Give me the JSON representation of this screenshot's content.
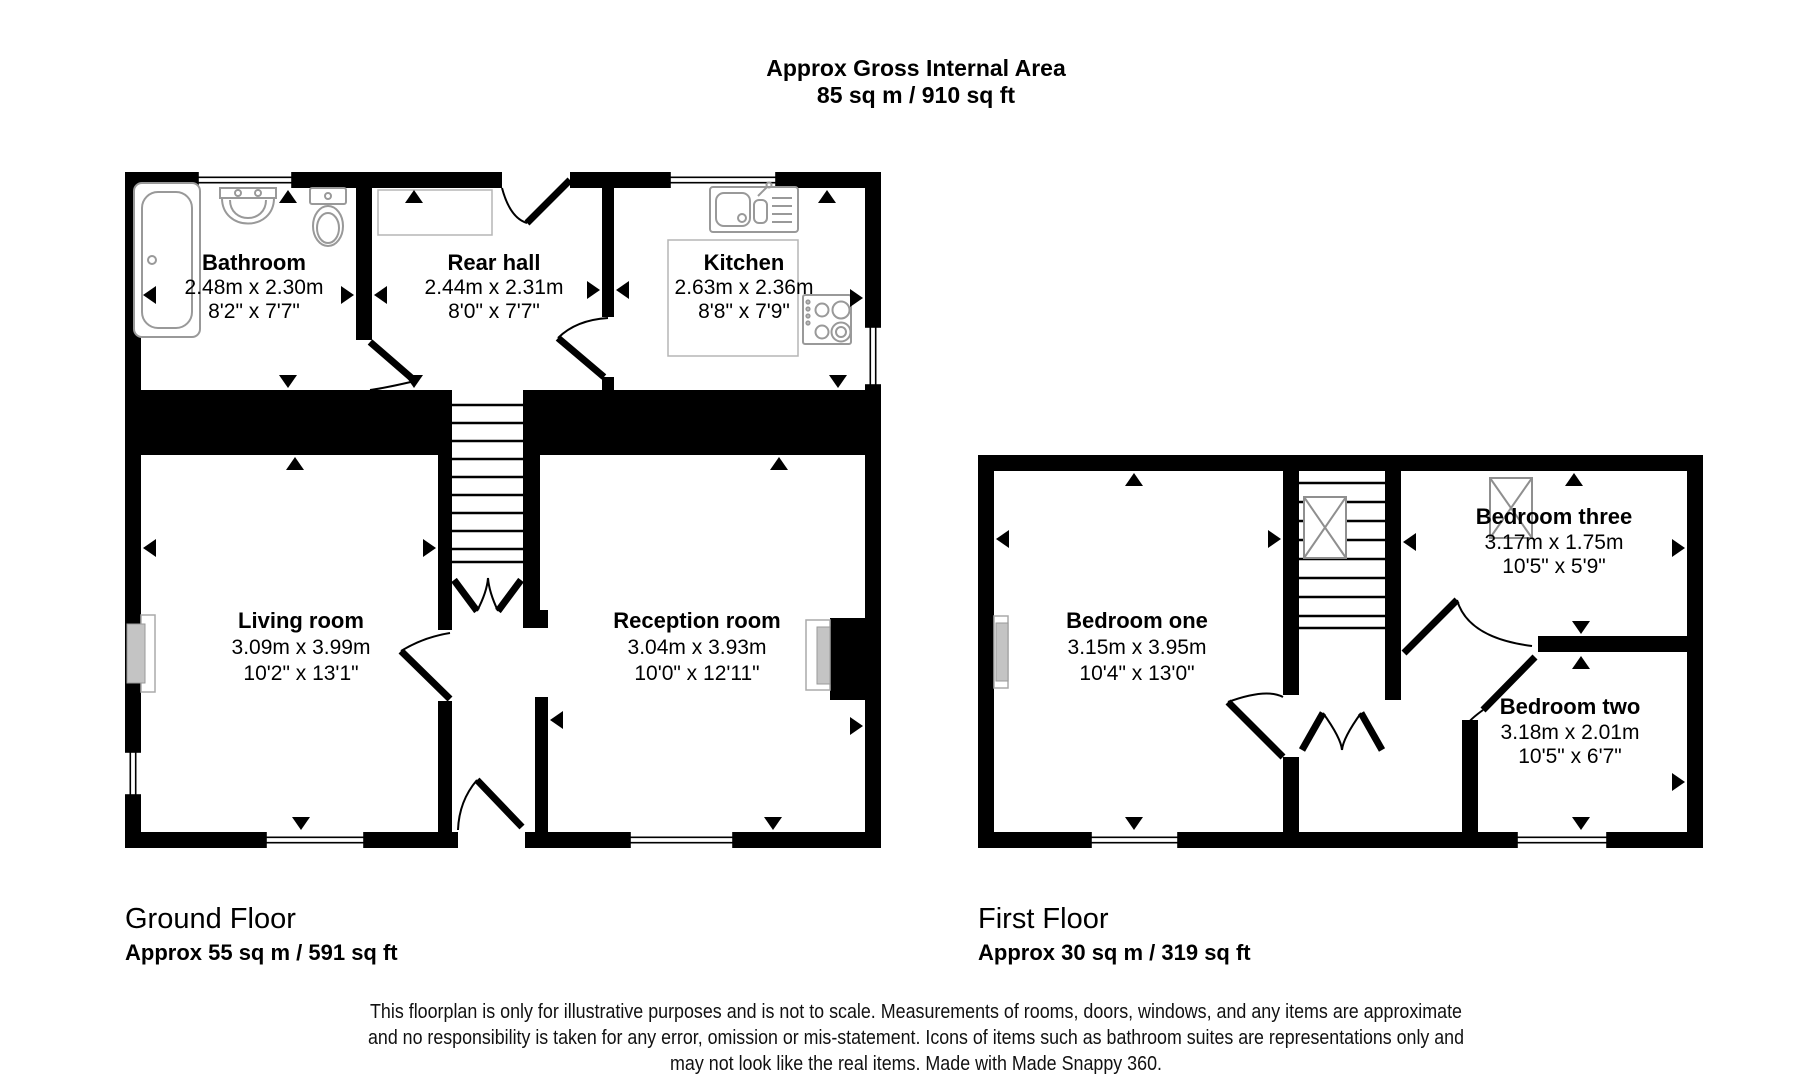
{
  "header": {
    "title": "Approx Gross Internal Area",
    "area": "85 sq m / 910 sq ft"
  },
  "ground_floor": {
    "title": "Ground Floor",
    "area_label": "Approx 55 sq m / 591 sq ft",
    "rooms": {
      "bathroom": {
        "name": "Bathroom",
        "metric": "2.48m x 2.30m",
        "imperial": "8'2\" x 7'7\""
      },
      "rear_hall": {
        "name": "Rear hall",
        "metric": "2.44m x 2.31m",
        "imperial": "8'0\" x 7'7\""
      },
      "kitchen": {
        "name": "Kitchen",
        "metric": "2.63m x 2.36m",
        "imperial": "8'8\" x 7'9\""
      },
      "living_room": {
        "name": "Living room",
        "metric": "3.09m x 3.99m",
        "imperial": "10'2\" x 13'1\""
      },
      "reception_room": {
        "name": "Reception room",
        "metric": "3.04m x 3.93m",
        "imperial": "10'0\" x 12'11\""
      }
    }
  },
  "first_floor": {
    "title": "First Floor",
    "area_label": "Approx 30 sq m / 319 sq ft",
    "rooms": {
      "bedroom_one": {
        "name": "Bedroom one",
        "metric": "3.15m x 3.95m",
        "imperial": "10'4\" x 13'0\""
      },
      "bedroom_three": {
        "name": "Bedroom three",
        "metric": "3.17m x 1.75m",
        "imperial": "10'5\" x 5'9\""
      },
      "bedroom_two": {
        "name": "Bedroom two",
        "metric": "3.18m x 2.01m",
        "imperial": "10'5\" x 6'7\""
      }
    }
  },
  "footer": {
    "line1": "This floorplan is only for illustrative purposes and is not to scale. Measurements of rooms, doors, windows, and any items are approximate",
    "line2": "and no responsibility is taken for any error, omission or mis-statement. Icons of items such as bathroom suites are representations only and",
    "line3": "may not look like the real items. Made with Made Snappy 360."
  },
  "colors": {
    "background": "#ffffff",
    "wall": "#000000",
    "fixture_line": "#999999",
    "fireplace_fill": "#c4c4c4"
  }
}
